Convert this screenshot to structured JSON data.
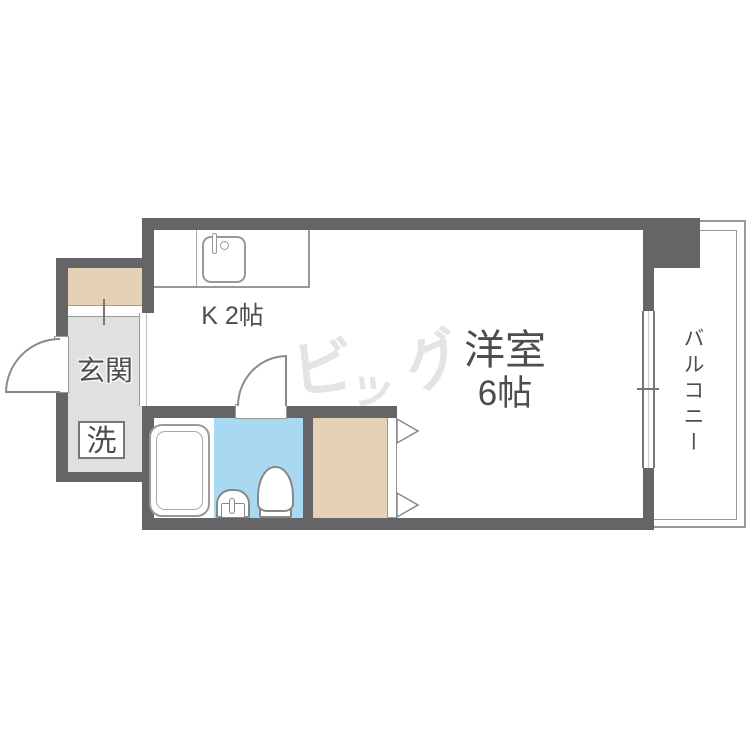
{
  "rooms": {
    "kitchen_label": "K 2帖",
    "entrance_label": "玄関",
    "washer_label": "洗",
    "western_room_label": "洋室",
    "western_room_size": "6帖",
    "balcony_label": "バルコニー"
  },
  "watermark": {
    "text": "ビッグ",
    "chars": [
      "ビ",
      "ッ",
      "グ"
    ]
  },
  "colors": {
    "wall": "#656567",
    "entrance_floor": "#e0e0e2",
    "wood": "#e5d2b6",
    "bathroom_floor": "#a8d8f2",
    "fixture_outline": "#8a8a8a",
    "text": "#4d4d4d",
    "watermark": "#e4e4e4"
  }
}
